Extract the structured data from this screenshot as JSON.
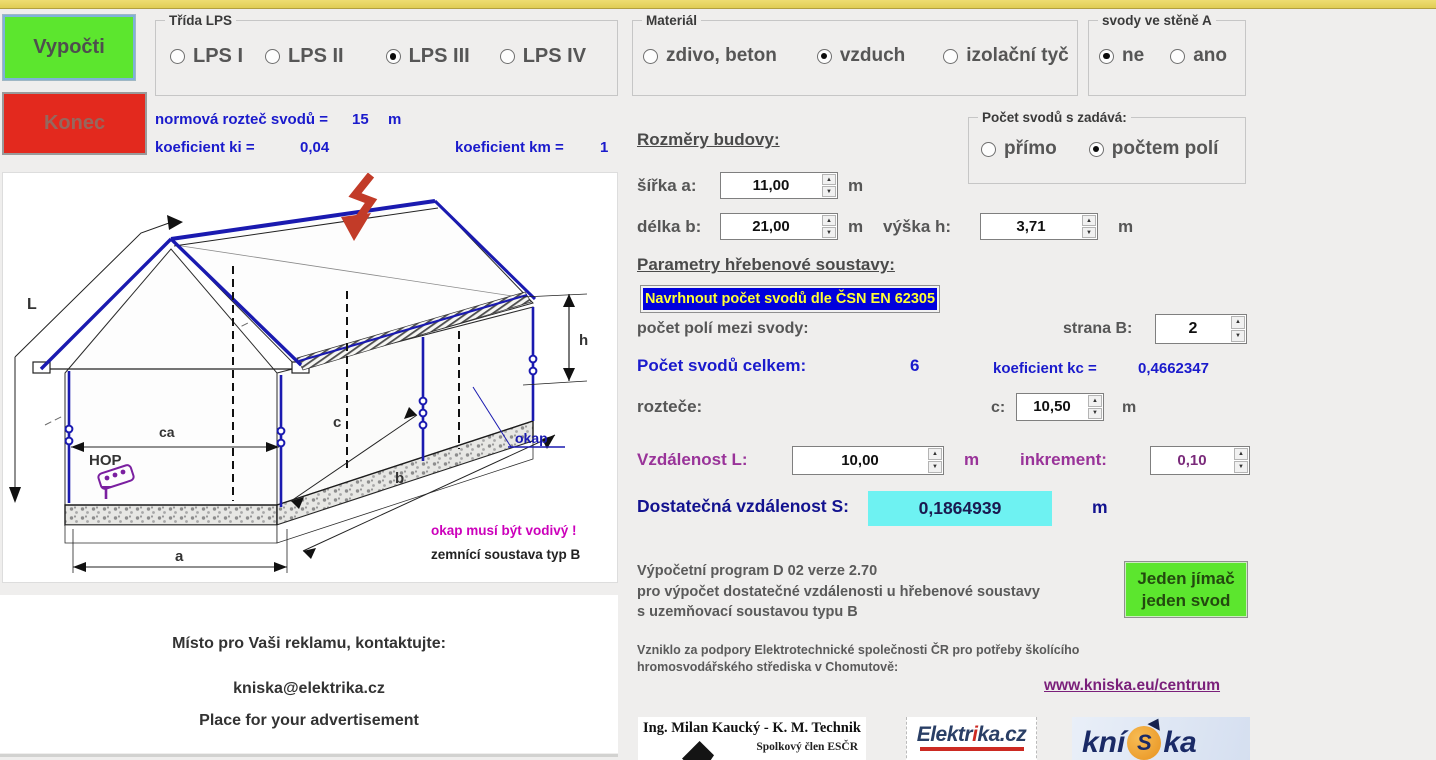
{
  "buttons": {
    "compute": "Vypočti",
    "exit": "Konec",
    "propose": "Navrhnout počet svodů dle ČSN EN 62305",
    "single_line1": "Jeden jímač",
    "single_line2": "jeden svod"
  },
  "groups": {
    "lps": {
      "legend": "Třída LPS",
      "options": [
        {
          "label": "LPS I",
          "selected": false
        },
        {
          "label": "LPS II",
          "selected": false
        },
        {
          "label": "LPS III",
          "selected": true
        },
        {
          "label": "LPS IV",
          "selected": false
        }
      ]
    },
    "material": {
      "legend": "Materiál",
      "options": [
        {
          "label": "zdivo, beton",
          "selected": false
        },
        {
          "label": "vzduch",
          "selected": true
        },
        {
          "label": "izolační tyč",
          "selected": false
        }
      ]
    },
    "wall": {
      "legend": "svody ve stěně A",
      "options": [
        {
          "label": "ne",
          "selected": true
        },
        {
          "label": "ano",
          "selected": false
        }
      ]
    },
    "entry_mode": {
      "legend": "Počet svodů s zadává:",
      "options": [
        {
          "label": "přímo",
          "selected": false
        },
        {
          "label": "počtem polí",
          "selected": true
        }
      ]
    }
  },
  "coefficients": {
    "spacing_label": "normová rozteč svodů =",
    "spacing_value": "15",
    "spacing_unit": "m",
    "ki_label": "koeficient  ki =",
    "ki_value": "0,04",
    "km_label": "koeficient  km =",
    "km_value": "1",
    "kc_label": "koeficient  kc =",
    "kc_value": "0,4662347"
  },
  "dimensions": {
    "heading": "Rozměry budovy:",
    "width_label": "šířka  a:",
    "width_value": "11,00",
    "width_unit": "m",
    "length_label": "délka  b:",
    "length_value": "21,00",
    "length_unit": "m",
    "height_label": "výška  h:",
    "height_value": "3,71",
    "height_unit": "m"
  },
  "ridge": {
    "heading": "Parametry hřebenové soustavy:",
    "fields_label": "počet polí mezi svody:",
    "sideB_label": "strana B:",
    "sideB_value": "2",
    "total_label": "Počet svodů celkem:",
    "total_value": "6",
    "spacing_label": "rozteče:",
    "c_label": "c:",
    "c_value": "10,50",
    "c_unit": "m"
  },
  "distance": {
    "L_label": "Vzdálenost  L:",
    "L_value": "10,00",
    "L_unit": "m",
    "increment_label": "inkrement:",
    "increment_value": "0,10",
    "S_label": "Dostatečná vzdálenost  S:",
    "S_value": "0,1864939",
    "S_unit": "m"
  },
  "about": {
    "line1": "Výpočetní program D 02 verze 2.70",
    "line2": "pro výpočet dostatečné vzdálenosti u hřebenové soustavy",
    "line3": "s uzemňovací soustavou typu B",
    "support1": "Vzniklo za podpory Elektrotechnické společnosti ČR pro potřeby školícího",
    "support2": "hromosvodářského střediska v Chomutově:",
    "link": "www.kniska.eu/centrum"
  },
  "ad": {
    "line1": "Místo pro Vaši reklamu, kontaktujte:",
    "line2": "kniska@elektrika.cz",
    "line3": "Place for your advertisement"
  },
  "logos": {
    "kmtechnik": {
      "title": "Ing. Milan Kaucký - K. M. Technik",
      "subtitle": "Spolkový člen ESČR"
    },
    "elektrika": {
      "pre": "Elektr",
      "accent": "i",
      "post": "ka.cz"
    },
    "kniska": {
      "pre": "kní",
      "ball": "S",
      "post": "ka"
    }
  },
  "diagram": {
    "labels": {
      "L": "L",
      "h": "h",
      "ca": "ca",
      "c": "c",
      "a": "a",
      "b": "b",
      "hop": "HOP",
      "okap": "okap"
    },
    "note_magenta": "okap musí být vodivý !",
    "note_black": "zemnící soustava typ B"
  },
  "colors": {
    "accent_blue": "#1a1acc",
    "purple": "#993399",
    "navy": "#12128f",
    "result_bg": "#6ef2f2",
    "compute_green": "#5ce62e",
    "exit_red": "#e3291e",
    "propose_bg": "#0000dd",
    "propose_text": "#ffff33",
    "link": "#7a1f7a",
    "magenta": "#cc00bb"
  }
}
